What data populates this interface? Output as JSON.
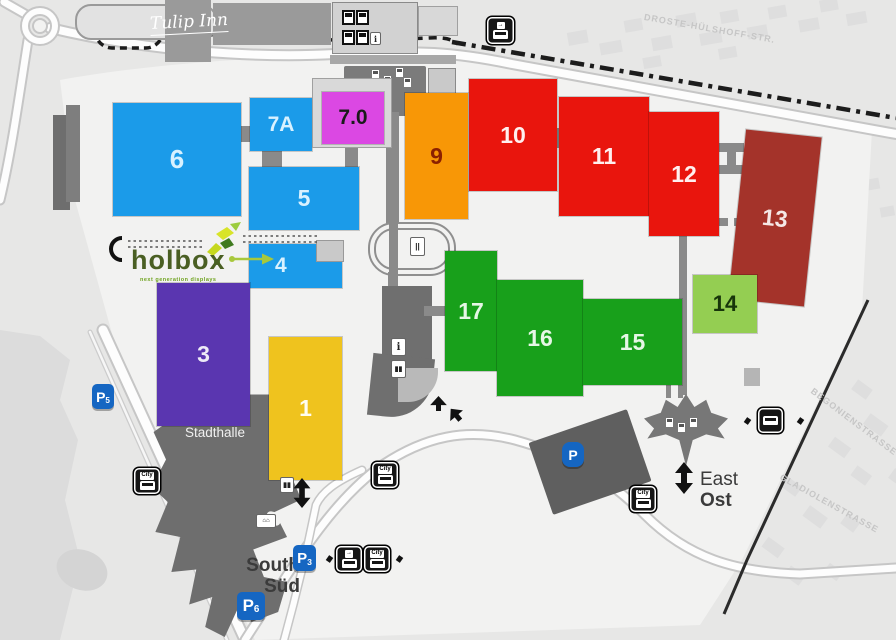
{
  "map": {
    "halls": [
      {
        "id": "6",
        "label": "6",
        "color": "#1B9BE9",
        "text_color": "#D8F1FF"
      },
      {
        "id": "7A",
        "label": "7A",
        "color": "#1B9BE9",
        "text_color": "#D8F1FF"
      },
      {
        "id": "7.0",
        "label": "7.0",
        "color": "#DB48E3",
        "text_color": "#1A1A1A"
      },
      {
        "id": "5",
        "label": "5",
        "color": "#1B9BE9",
        "text_color": "#D8F1FF"
      },
      {
        "id": "4",
        "label": "4",
        "color": "#1B9BE9",
        "text_color": "#D8F1FF"
      },
      {
        "id": "3",
        "label": "3",
        "color": "#5A36B0",
        "text_color": "#EDEAF7"
      },
      {
        "id": "1",
        "label": "1",
        "color": "#EFC31E",
        "text_color": "#FFFDF2"
      },
      {
        "id": "9",
        "label": "9",
        "color": "#F89706",
        "text_color": "#8B2000"
      },
      {
        "id": "10",
        "label": "10",
        "color": "#E9150D",
        "text_color": "#FFEFEF"
      },
      {
        "id": "11",
        "label": "11",
        "color": "#E9150D",
        "text_color": "#FFEFEF"
      },
      {
        "id": "12",
        "label": "12",
        "color": "#E9150D",
        "text_color": "#FFEFEF"
      },
      {
        "id": "13",
        "label": "13",
        "color": "#A4332A",
        "text_color": "#F5E8E6"
      },
      {
        "id": "14",
        "label": "14",
        "color": "#94CE52",
        "text_color": "#17350A"
      },
      {
        "id": "17",
        "label": "17",
        "color": "#18A01B",
        "text_color": "#E6F7E6"
      },
      {
        "id": "16",
        "label": "16",
        "color": "#18A01B",
        "text_color": "#E6F7E6"
      },
      {
        "id": "15",
        "label": "15",
        "color": "#18A01B",
        "text_color": "#E6F7E6"
      }
    ],
    "landmarks": {
      "tulip_inn": "Tulip Inn",
      "stadthalle": "Stadthalle",
      "entrance": "Eingang",
      "south": {
        "en": "South",
        "de": "Süd"
      },
      "east": {
        "en": "East",
        "de": "Ost"
      }
    },
    "brand": {
      "name": "holbox",
      "tagline": "next generation displays"
    },
    "streets": {
      "north": "DROSTE-HÜLSHOFF-STR.",
      "east_upper": "BEGONIENSTRASSE",
      "east_lower": "GLADIOLENSTRASSE"
    },
    "parking": {
      "p3": {
        "letter": "P",
        "sub": "3"
      },
      "p5": {
        "letter": "P",
        "sub": "5"
      },
      "p6": {
        "letter": "P",
        "sub": "6"
      },
      "east": {
        "letter": "P",
        "sub": ""
      }
    },
    "transit": {
      "city_shuttle": "City",
      "arrow_symbol": "→"
    },
    "colors": {
      "map_background": "#E7E7E6",
      "site_background": "#F2F2F1",
      "road_white": "#FDFDFD",
      "building_gray": "#9A9A9A",
      "dark_building_gray": "#6F6F6F",
      "railway_black": "#1C1C1C",
      "parking_blue": "#1566C2",
      "holbox_text_green": "#4A5F23",
      "holbox_lime": "#BFD41E",
      "street_label_gray": "#C6C6C6"
    }
  }
}
